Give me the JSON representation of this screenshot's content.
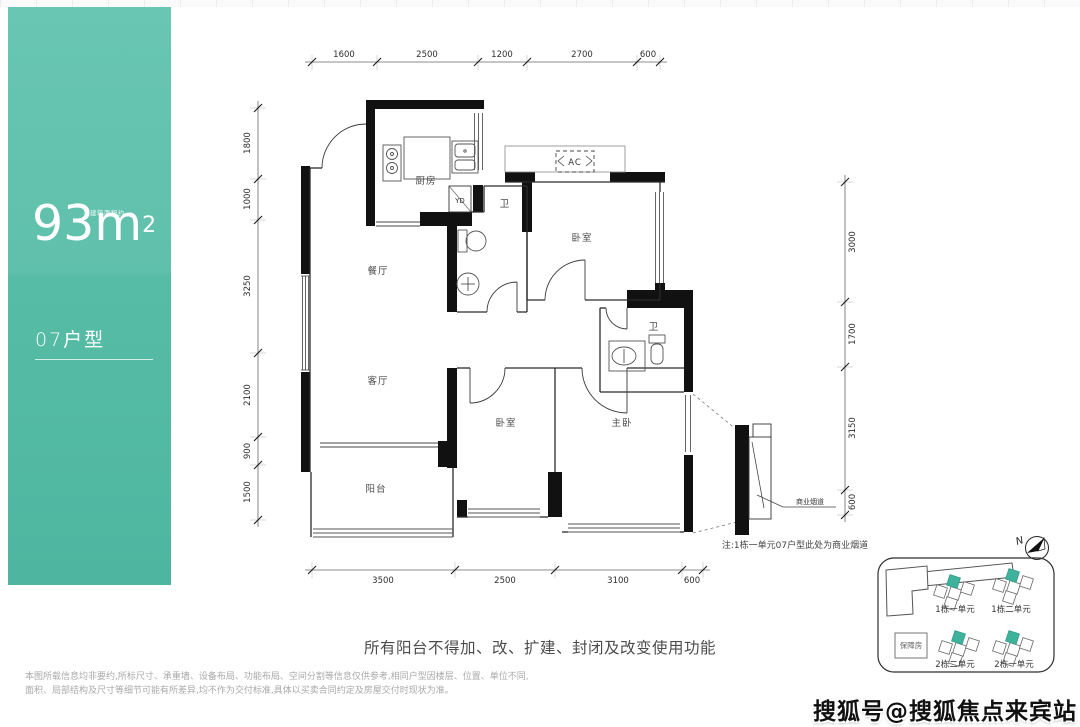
{
  "left_panel": {
    "area_prefix_label": "建筑面积约",
    "area_number": "93",
    "area_unit": "m",
    "area_sup": "2",
    "unit_type": "07户型"
  },
  "plan": {
    "rooms": {
      "kitchen": "厨房",
      "dining": "餐厅",
      "living": "客厅",
      "balcony": "阳台",
      "bath1": "卫",
      "bath2": "卫",
      "bedroom_top": "卧室",
      "bedroom_mid": "卧室",
      "master": "主卧"
    },
    "fixtures": {
      "yd": "YD",
      "ac": "AC"
    },
    "flue_label": "商业烟道",
    "note": "注:1栋一单元07户型此处为商业烟道",
    "dims_top": [
      "1600",
      "2500",
      "1200",
      "2700",
      "600"
    ],
    "dims_left": [
      "1800",
      "1000",
      "3250",
      "2100",
      "900",
      "1500"
    ],
    "dims_right": [
      "3000",
      "1700",
      "3150",
      "600"
    ],
    "dims_bottom": [
      "3500",
      "2500",
      "3100",
      "600"
    ]
  },
  "site_plan": {
    "north_label": "N",
    "unit_labels": [
      "1栋一单元",
      "1栋二单元",
      "2栋二单元",
      "2栋一单元"
    ],
    "affordable_housing": "保障房",
    "highlight_color": "#3fb29c"
  },
  "footer": {
    "notice": "所有阳台不得加、改、扩建、封闭及改变使用功能",
    "disclaimer_line1": "本图所载信息均非要约,所标尺寸、承重墙、设备布局、功能布局、空间分割等信息仅供参考,相同户型因楼层、位置、单位不同,",
    "disclaimer_line2": "面积、局部结构及尺寸等细节可能有所差异,均不作为交付标准,具体以买卖合同约定及房屋交付时现状为准。"
  },
  "watermark": "搜狐号@搜狐焦点来宾站"
}
